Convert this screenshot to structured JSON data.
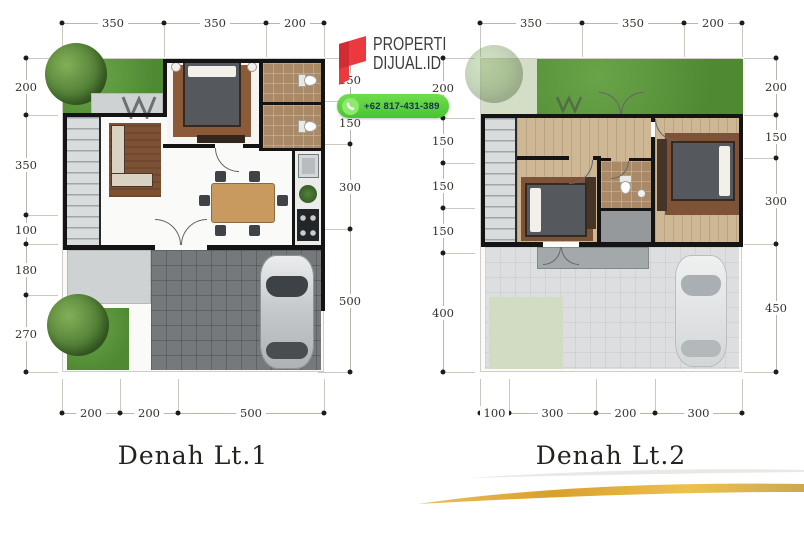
{
  "brand": {
    "name_line1": "PROPERTI",
    "name_line2": "DIJUAL.ID",
    "accent_red": "#e73b3e",
    "text_color": "#3d3d3b"
  },
  "contact": {
    "phone": "+62 817-431-389",
    "badge_color": "#46c62e"
  },
  "plans": [
    {
      "title": "Denah Lt.1",
      "dims_top": [
        "350",
        "350",
        "200"
      ],
      "dims_left": [
        "200",
        "350",
        "100",
        "180",
        "270"
      ],
      "dims_right": [
        "150",
        "150",
        "300",
        "500"
      ],
      "dims_bottom": [
        "200",
        "200",
        "500"
      ]
    },
    {
      "title": "Denah Lt.2",
      "dims_top": [
        "350",
        "350",
        "200"
      ],
      "dims_left": [
        "200",
        "150",
        "150",
        "150",
        "400"
      ],
      "dims_right": [
        "200",
        "150",
        "300",
        "450"
      ],
      "dims_bottom": [
        "100",
        "300",
        "200",
        "300"
      ]
    }
  ],
  "decor": {
    "swoosh_gold": "#d9a435"
  }
}
